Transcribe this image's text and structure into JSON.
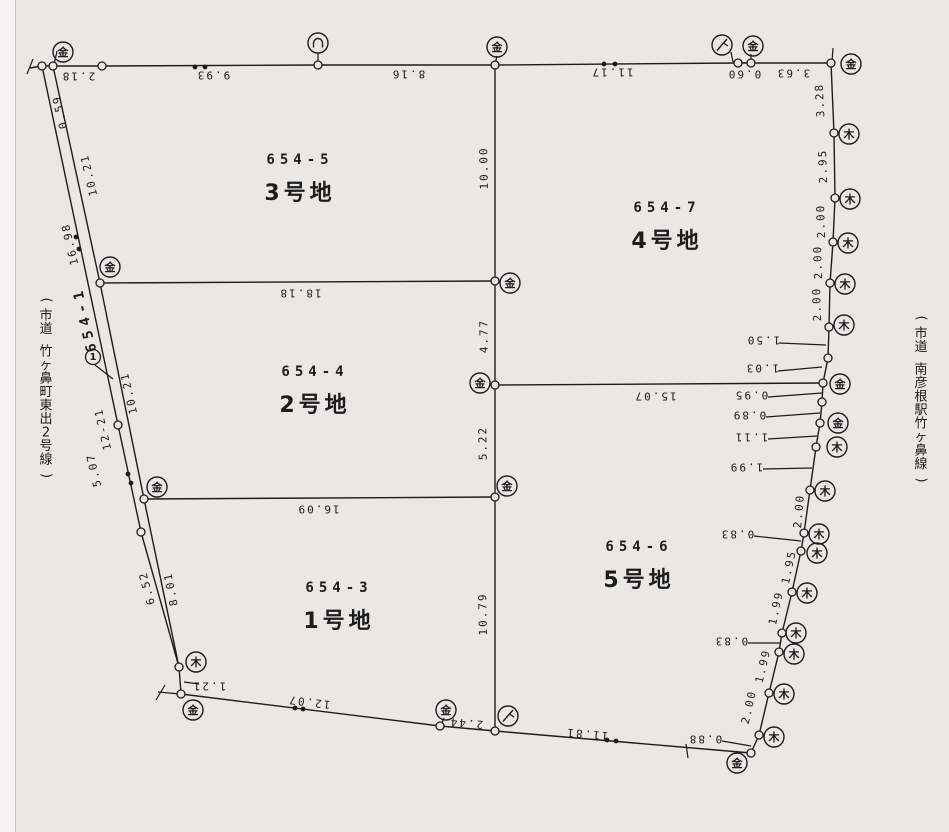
{
  "page": {
    "width": 949,
    "height": 832,
    "paper_color": "#eae8e2",
    "ink_color": "#1c1c1c",
    "title": "地積測量図 (cadastral survey plan)"
  },
  "parcels": [
    {
      "lot": "654-5",
      "name": "3号地",
      "x": 300,
      "y": 164
    },
    {
      "lot": "654-7",
      "name": "4号地",
      "x": 667,
      "y": 212
    },
    {
      "lot": "654-4",
      "name": "2号地",
      "x": 315,
      "y": 376
    },
    {
      "lot": "654-6",
      "name": "5号地",
      "x": 639,
      "y": 551
    },
    {
      "lot": "654-3",
      "name": "1号地",
      "x": 339,
      "y": 592
    }
  ],
  "road_parcel": {
    "lot": "654-1",
    "point_no": "1",
    "x": 85,
    "y": 319,
    "rot": -103,
    "circle": [
      93,
      357
    ],
    "leader": [
      95,
      365,
      113,
      379
    ]
  },
  "road_names": [
    {
      "text": "(市道 竹ヶ鼻町東出2号線)",
      "chars": "市道 竹ヶ鼻町東出2号線",
      "x": 46,
      "y": 300
    },
    {
      "text": "(市道 南彦根駅竹ヶ鼻線)",
      "chars": "市道 南彦根駅竹ヶ鼻線",
      "x": 921,
      "y": 318
    }
  ],
  "boundaries": [
    {
      "id": "north-edge",
      "pts": [
        [
          30,
          68
        ],
        [
          42,
          66
        ],
        [
          53,
          66
        ],
        [
          102,
          66
        ],
        [
          318,
          65
        ],
        [
          495,
          65
        ],
        [
          738,
          63
        ],
        [
          751,
          63
        ],
        [
          831,
          63
        ]
      ]
    },
    {
      "id": "east-edge",
      "pts": [
        [
          831,
          63
        ],
        [
          834,
          133
        ],
        [
          835,
          198
        ],
        [
          833,
          242
        ],
        [
          830,
          283
        ],
        [
          829,
          327
        ],
        [
          828,
          358
        ],
        [
          823,
          383
        ],
        [
          822,
          402
        ],
        [
          820,
          423
        ],
        [
          816,
          447
        ],
        [
          810,
          490
        ],
        [
          804,
          533
        ],
        [
          801,
          551
        ],
        [
          792,
          592
        ],
        [
          782,
          633
        ],
        [
          779,
          652
        ],
        [
          769,
          693
        ],
        [
          759,
          735
        ],
        [
          751,
          753
        ]
      ]
    },
    {
      "id": "south-edge",
      "pts": [
        [
          751,
          753
        ],
        [
          495,
          731
        ],
        [
          440,
          726
        ],
        [
          181,
          694
        ]
      ]
    },
    {
      "id": "road-outer",
      "pts": [
        [
          42,
          66
        ],
        [
          118,
          425
        ],
        [
          141,
          532
        ],
        [
          179,
          667
        ],
        [
          181,
          694
        ]
      ]
    },
    {
      "id": "road-inner",
      "pts": [
        [
          53,
          66
        ],
        [
          100,
          283
        ],
        [
          144,
          499
        ],
        [
          179,
          667
        ]
      ]
    },
    {
      "id": "center-line",
      "pts": [
        [
          495,
          65
        ],
        [
          495,
          731
        ]
      ]
    },
    {
      "id": "div-18-18",
      "pts": [
        [
          100,
          283
        ],
        [
          495,
          281
        ]
      ]
    },
    {
      "id": "div-15-07",
      "pts": [
        [
          495,
          385
        ],
        [
          823,
          383
        ]
      ]
    },
    {
      "id": "div-16-09",
      "pts": [
        [
          144,
          499
        ],
        [
          495,
          497
        ]
      ]
    }
  ],
  "survey_points": [
    [
      42,
      66
    ],
    [
      53,
      66
    ],
    [
      102,
      66
    ],
    [
      318,
      65
    ],
    [
      495,
      65
    ],
    [
      738,
      63
    ],
    [
      751,
      63
    ],
    [
      831,
      63
    ],
    [
      834,
      133
    ],
    [
      835,
      198
    ],
    [
      833,
      242
    ],
    [
      830,
      283
    ],
    [
      829,
      327
    ],
    [
      828,
      358
    ],
    [
      823,
      383
    ],
    [
      822,
      402
    ],
    [
      820,
      423
    ],
    [
      816,
      447
    ],
    [
      810,
      490
    ],
    [
      804,
      533
    ],
    [
      801,
      551
    ],
    [
      792,
      592
    ],
    [
      782,
      633
    ],
    [
      779,
      652
    ],
    [
      769,
      693
    ],
    [
      759,
      735
    ],
    [
      751,
      753
    ],
    [
      495,
      731
    ],
    [
      440,
      726
    ],
    [
      181,
      694
    ],
    [
      118,
      425
    ],
    [
      141,
      532
    ],
    [
      179,
      667
    ],
    [
      100,
      283
    ],
    [
      144,
      499
    ],
    [
      495,
      281
    ],
    [
      495,
      385
    ],
    [
      495,
      497
    ]
  ],
  "markers": [
    {
      "type": "kanji",
      "glyph": "金",
      "x": 63,
      "y": 52
    },
    {
      "type": "arc",
      "glyph": "∩",
      "x": 318,
      "y": 43
    },
    {
      "type": "kanji",
      "glyph": "金",
      "x": 497,
      "y": 47
    },
    {
      "type": "slash",
      "glyph": "ノ",
      "x": 722,
      "y": 45
    },
    {
      "type": "kanji",
      "glyph": "金",
      "x": 753,
      "y": 46
    },
    {
      "type": "kanji",
      "glyph": "金",
      "x": 851,
      "y": 64
    },
    {
      "type": "kanji",
      "glyph": "木",
      "x": 849,
      "y": 134
    },
    {
      "type": "kanji",
      "glyph": "木",
      "x": 850,
      "y": 199
    },
    {
      "type": "kanji",
      "glyph": "木",
      "x": 848,
      "y": 243
    },
    {
      "type": "kanji",
      "glyph": "木",
      "x": 845,
      "y": 284
    },
    {
      "type": "kanji",
      "glyph": "木",
      "x": 844,
      "y": 325
    },
    {
      "type": "kanji",
      "glyph": "金",
      "x": 840,
      "y": 384
    },
    {
      "type": "kanji",
      "glyph": "金",
      "x": 838,
      "y": 423
    },
    {
      "type": "kanji",
      "glyph": "木",
      "x": 837,
      "y": 447
    },
    {
      "type": "kanji",
      "glyph": "木",
      "x": 825,
      "y": 491
    },
    {
      "type": "kanji",
      "glyph": "木",
      "x": 819,
      "y": 534
    },
    {
      "type": "kanji",
      "glyph": "木",
      "x": 817,
      "y": 553
    },
    {
      "type": "kanji",
      "glyph": "木",
      "x": 807,
      "y": 593
    },
    {
      "type": "kanji",
      "glyph": "木",
      "x": 796,
      "y": 633
    },
    {
      "type": "kanji",
      "glyph": "木",
      "x": 794,
      "y": 654
    },
    {
      "type": "kanji",
      "glyph": "木",
      "x": 784,
      "y": 694
    },
    {
      "type": "kanji",
      "glyph": "木",
      "x": 774,
      "y": 737
    },
    {
      "type": "kanji",
      "glyph": "金",
      "x": 737,
      "y": 763
    },
    {
      "type": "slash",
      "glyph": "ノ",
      "x": 508,
      "y": 716
    },
    {
      "type": "kanji",
      "glyph": "金",
      "x": 446,
      "y": 710
    },
    {
      "type": "kanji",
      "glyph": "金",
      "x": 193,
      "y": 710
    },
    {
      "type": "kanji",
      "glyph": "木",
      "x": 196,
      "y": 662
    },
    {
      "type": "kanji",
      "glyph": "金",
      "x": 110,
      "y": 267
    },
    {
      "type": "kanji",
      "glyph": "金",
      "x": 510,
      "y": 283
    },
    {
      "type": "kanji",
      "glyph": "金",
      "x": 480,
      "y": 383
    },
    {
      "type": "kanji",
      "glyph": "金",
      "x": 157,
      "y": 487
    },
    {
      "type": "kanji",
      "glyph": "金",
      "x": 507,
      "y": 486
    }
  ],
  "dimension_labels": [
    {
      "text": "2.18",
      "x": 78,
      "y": 76,
      "rot": 180
    },
    {
      "text": "9.93",
      "x": 213,
      "y": 75,
      "rot": 180
    },
    {
      "text": "8.16",
      "x": 408,
      "y": 74,
      "rot": 180
    },
    {
      "text": "11.17",
      "x": 612,
      "y": 72,
      "rot": 180
    },
    {
      "text": "0.60",
      "x": 744,
      "y": 74,
      "rot": 180
    },
    {
      "text": "3.63",
      "x": 793,
      "y": 73,
      "rot": 180
    },
    {
      "text": "3.28",
      "x": 820,
      "y": 100,
      "rot": -93
    },
    {
      "text": "2.95",
      "x": 823,
      "y": 166,
      "rot": -92
    },
    {
      "text": "2.00",
      "x": 821,
      "y": 221,
      "rot": -92
    },
    {
      "text": "2.00",
      "x": 818,
      "y": 262,
      "rot": -92
    },
    {
      "text": "2.00",
      "x": 817,
      "y": 304,
      "rot": -92
    },
    {
      "text": "1.50",
      "x": 763,
      "y": 340,
      "rot": 180
    },
    {
      "text": "1.03",
      "x": 762,
      "y": 368,
      "rot": 180
    },
    {
      "text": "0.95",
      "x": 751,
      "y": 395,
      "rot": 180
    },
    {
      "text": "0.89",
      "x": 749,
      "y": 415,
      "rot": 180
    },
    {
      "text": "1.11",
      "x": 751,
      "y": 437,
      "rot": 180
    },
    {
      "text": "1.99",
      "x": 746,
      "y": 467,
      "rot": 180
    },
    {
      "text": "2.00",
      "x": 799,
      "y": 511,
      "rot": -85
    },
    {
      "text": "0.83",
      "x": 737,
      "y": 534,
      "rot": 180
    },
    {
      "text": "1.95",
      "x": 789,
      "y": 567,
      "rot": -78
    },
    {
      "text": "1.99",
      "x": 776,
      "y": 608,
      "rot": -78
    },
    {
      "text": "0.83",
      "x": 731,
      "y": 641,
      "rot": 180
    },
    {
      "text": "1.99",
      "x": 763,
      "y": 666,
      "rot": -77
    },
    {
      "text": "2.00",
      "x": 749,
      "y": 707,
      "rot": -77
    },
    {
      "text": "0.88",
      "x": 705,
      "y": 739,
      "rot": 180
    },
    {
      "text": "12.07",
      "x": 309,
      "y": 702,
      "rot": 187
    },
    {
      "text": "2.44",
      "x": 466,
      "y": 723,
      "rot": 185
    },
    {
      "text": "11.81",
      "x": 587,
      "y": 734,
      "rot": 185
    },
    {
      "text": "1.21",
      "x": 209,
      "y": 686,
      "rot": 180
    },
    {
      "text": "0.59",
      "x": 60,
      "y": 112,
      "rot": -103
    },
    {
      "text": "10.21",
      "x": 89,
      "y": 175,
      "rot": -103
    },
    {
      "text": "16.98",
      "x": 70,
      "y": 244,
      "rot": -103
    },
    {
      "text": "10.21",
      "x": 129,
      "y": 393,
      "rot": -103
    },
    {
      "text": "12-21",
      "x": 103,
      "y": 429,
      "rot": -103
    },
    {
      "text": "5.07",
      "x": 94,
      "y": 470,
      "rot": -103
    },
    {
      "text": "6.52",
      "x": 147,
      "y": 588,
      "rot": -105
    },
    {
      "text": "8.01",
      "x": 171,
      "y": 589,
      "rot": -101
    },
    {
      "text": "10.00",
      "x": 484,
      "y": 168,
      "rot": -91
    },
    {
      "text": "4.77",
      "x": 484,
      "y": 336,
      "rot": -91
    },
    {
      "text": "5.22",
      "x": 483,
      "y": 443,
      "rot": -91
    },
    {
      "text": "10.79",
      "x": 483,
      "y": 614,
      "rot": -91
    },
    {
      "text": "18.18",
      "x": 300,
      "y": 293,
      "rot": 180
    },
    {
      "text": "15.07",
      "x": 655,
      "y": 396,
      "rot": 180
    },
    {
      "text": "16.09",
      "x": 318,
      "y": 509,
      "rot": 180
    }
  ],
  "double_dots": [
    [
      195,
      67
    ],
    [
      205,
      67
    ],
    [
      604,
      64
    ],
    [
      615,
      64
    ],
    [
      76,
      237
    ],
    [
      79,
      249
    ],
    [
      128,
      474
    ],
    [
      131,
      483
    ],
    [
      295,
      708
    ],
    [
      303,
      709
    ],
    [
      607,
      740
    ],
    [
      616,
      741
    ]
  ],
  "ticks": [
    [
      33,
      59,
      27,
      74
    ],
    [
      57,
      51,
      54,
      65
    ],
    [
      318,
      53,
      318,
      65
    ],
    [
      497,
      56,
      495,
      64
    ],
    [
      731,
      52,
      733,
      62
    ],
    [
      751,
      54,
      751,
      62
    ],
    [
      833,
      48,
      832,
      62
    ],
    [
      779,
      343,
      826,
      345
    ],
    [
      778,
      371,
      822,
      367
    ],
    [
      768,
      397,
      822,
      393
    ],
    [
      766,
      417,
      820,
      413
    ],
    [
      768,
      439,
      817,
      436
    ],
    [
      763,
      469,
      812,
      468
    ],
    [
      754,
      536,
      801,
      541
    ],
    [
      748,
      643,
      780,
      643
    ],
    [
      722,
      741,
      751,
      746
    ],
    [
      184,
      682,
      199,
      684
    ],
    [
      686,
      744,
      688,
      758
    ],
    [
      158,
      692,
      180,
      694
    ],
    [
      165,
      685,
      156,
      700
    ],
    [
      444,
      718,
      441,
      725
    ],
    [
      95,
      365,
      113,
      379
    ]
  ]
}
